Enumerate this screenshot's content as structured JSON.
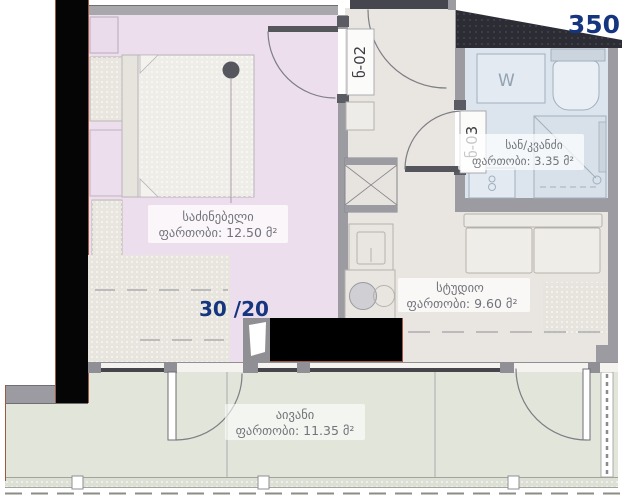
{
  "floor_plan": {
    "apartment_number": "350",
    "unit_label": "30 /20",
    "rooms": {
      "bedroom": {
        "name": "საძინებელი",
        "area": "ფართობი: 12.50 მ²"
      },
      "studio": {
        "name": "სტუდიო",
        "area": "ფართობი: 9.60 მ²"
      },
      "bathroom": {
        "name": "სან/კვანძი",
        "area": "ფართობი: 3.35 მ²"
      },
      "balcony": {
        "name": "აივანი",
        "area": "ფართობი: 11.35 მ²"
      }
    },
    "doors": {
      "entrance_tag": "ნ-02",
      "bathroom_tag": "ნ-03"
    },
    "fixtures": {
      "washing_machine": "W"
    },
    "colors": {
      "accent_blue": "#16357f",
      "bedroom_floor": "#ecdeed",
      "studio_floor": "#e9e6e2",
      "bathroom_floor": "#dce5ed",
      "balcony_floor": "#e1e5da",
      "wall_gray": "#9b9ba1",
      "accent_wall_black": "#000000",
      "exterior_trim_red": "#a05844"
    }
  }
}
